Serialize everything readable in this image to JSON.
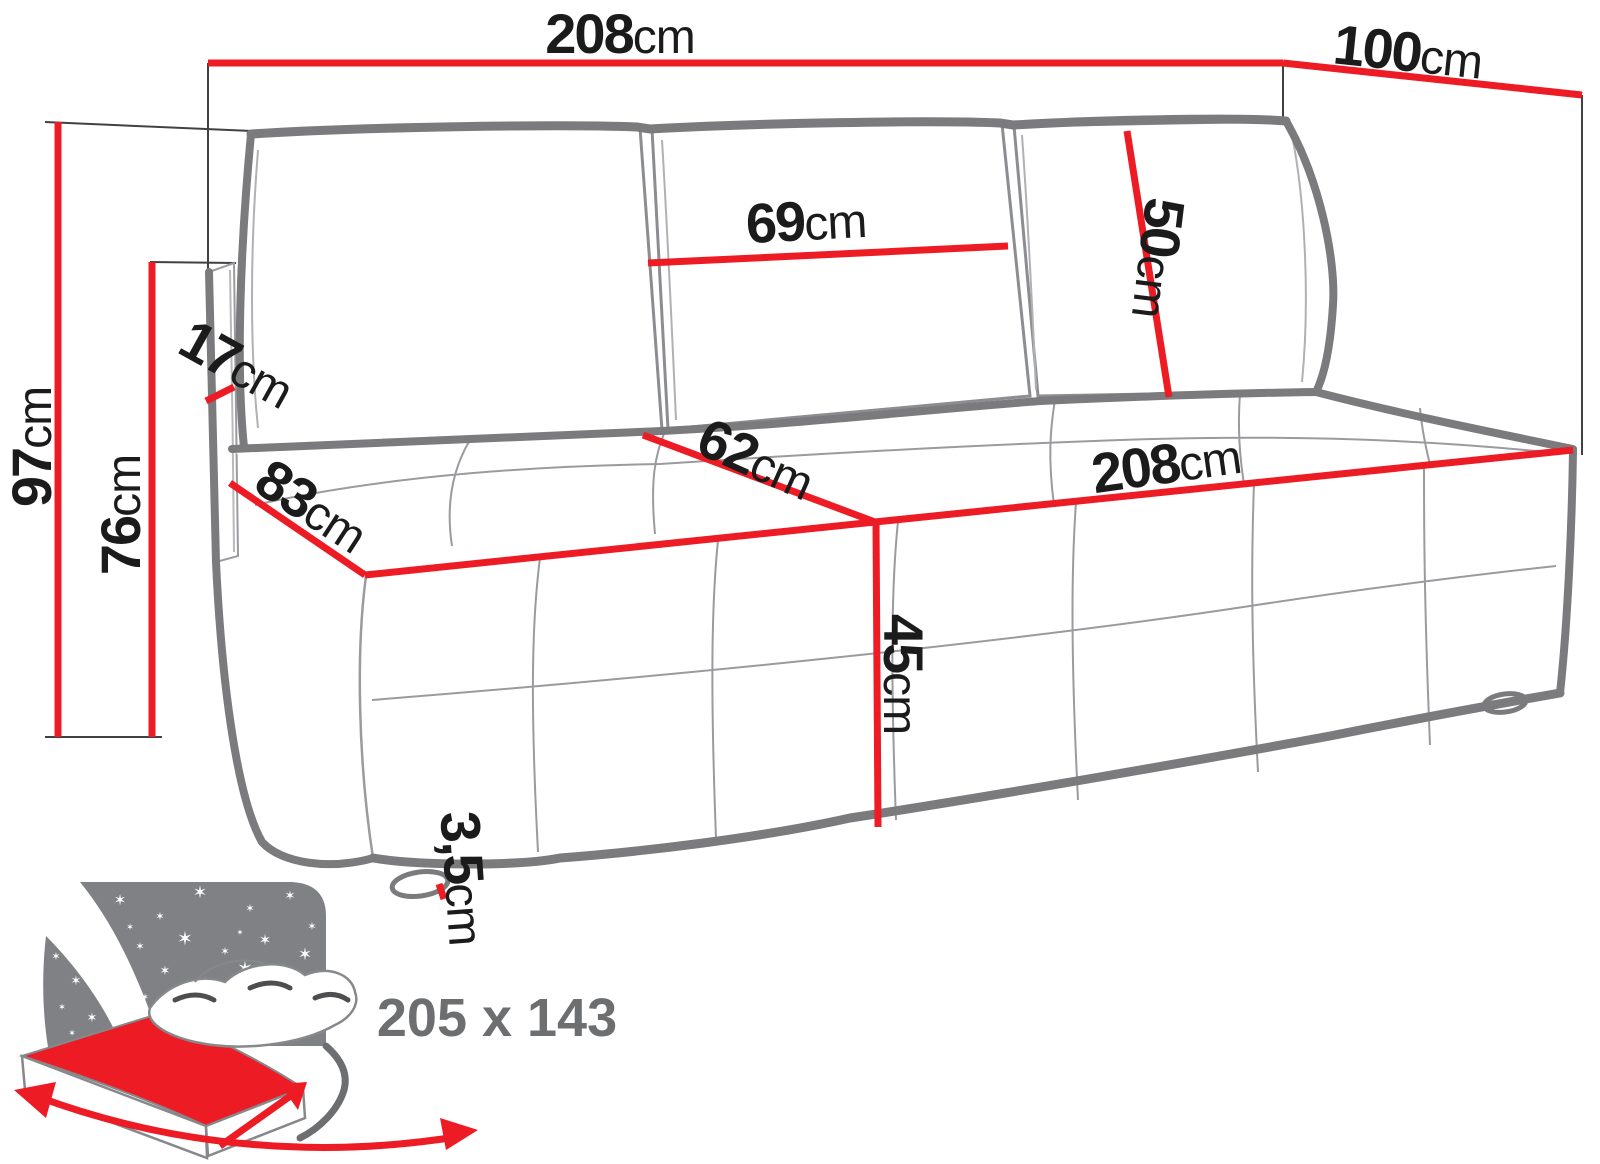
{
  "diagram": {
    "type": "sofa-bed dimension drawing",
    "colors": {
      "accent_red": "#ed1c24",
      "outline_gray": "#7b7b7d",
      "label_text": "#1b1b1b",
      "bed_label_gray": "#6d6e70",
      "star_panel_gray": "#808184"
    },
    "labels": {
      "total_width": {
        "value": "208",
        "unit": "cm"
      },
      "total_depth": {
        "value": "100",
        "unit": "cm"
      },
      "total_height": {
        "value": "97",
        "unit": "cm"
      },
      "backrest_height": {
        "value": "76",
        "unit": "cm"
      },
      "side_panel": {
        "value": "17",
        "unit": "cm"
      },
      "seat_depth_side": {
        "value": "83",
        "unit": "cm"
      },
      "back_cushion_width": {
        "value": "69",
        "unit": "cm"
      },
      "back_cushion_height": {
        "value": "50",
        "unit": "cm"
      },
      "seat_depth": {
        "value": "62",
        "unit": "cm"
      },
      "seat_width": {
        "value": "208",
        "unit": "cm"
      },
      "seat_height": {
        "value": "45",
        "unit": "cm"
      },
      "leg_height": {
        "value": "3,5",
        "unit": "cm"
      },
      "bed_surface": {
        "value": "205 x 143",
        "unit": ""
      }
    }
  }
}
